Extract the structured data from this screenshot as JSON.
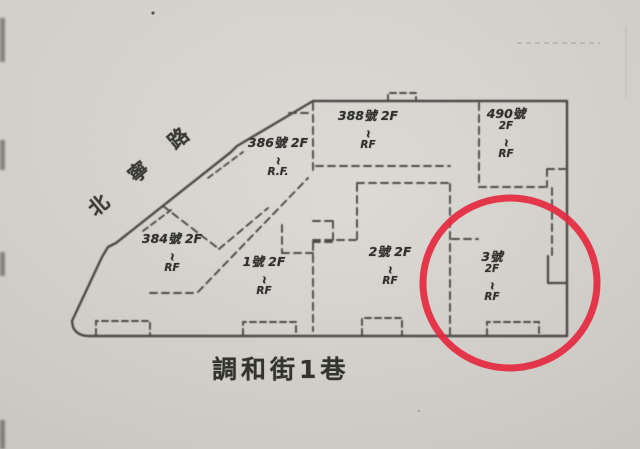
{
  "map": {
    "kind": "hand-drawn building lot sketch (scanned)",
    "streets": {
      "diagonal_label": "北寧路",
      "bottom_label": "調和街1巷"
    },
    "buildings": [
      {
        "name": "384號",
        "lines": [
          "384號 2F",
          "~",
          "RF"
        ]
      },
      {
        "name": "386號",
        "lines": [
          "386號 2F",
          "~",
          "R.F."
        ]
      },
      {
        "name": "388號",
        "lines": [
          "388號 2F",
          "~",
          "RF"
        ]
      },
      {
        "name": "490號",
        "lines": [
          "490號",
          "2F",
          "~",
          "RF"
        ]
      },
      {
        "name": "1號",
        "lines": [
          "1號 2F",
          "~",
          "RF"
        ]
      },
      {
        "name": "2號",
        "lines": [
          "2號 2F",
          "~",
          "RF"
        ]
      },
      {
        "name": "3號",
        "lines": [
          "3號",
          "2F",
          "~",
          "RF"
        ]
      }
    ],
    "annotation": {
      "shape": "red circle",
      "encircles": "3號",
      "color": "#e5293f"
    },
    "colors": {
      "paper": "#d8d5cf",
      "ink": "#383836",
      "red": "#e5293f"
    }
  }
}
